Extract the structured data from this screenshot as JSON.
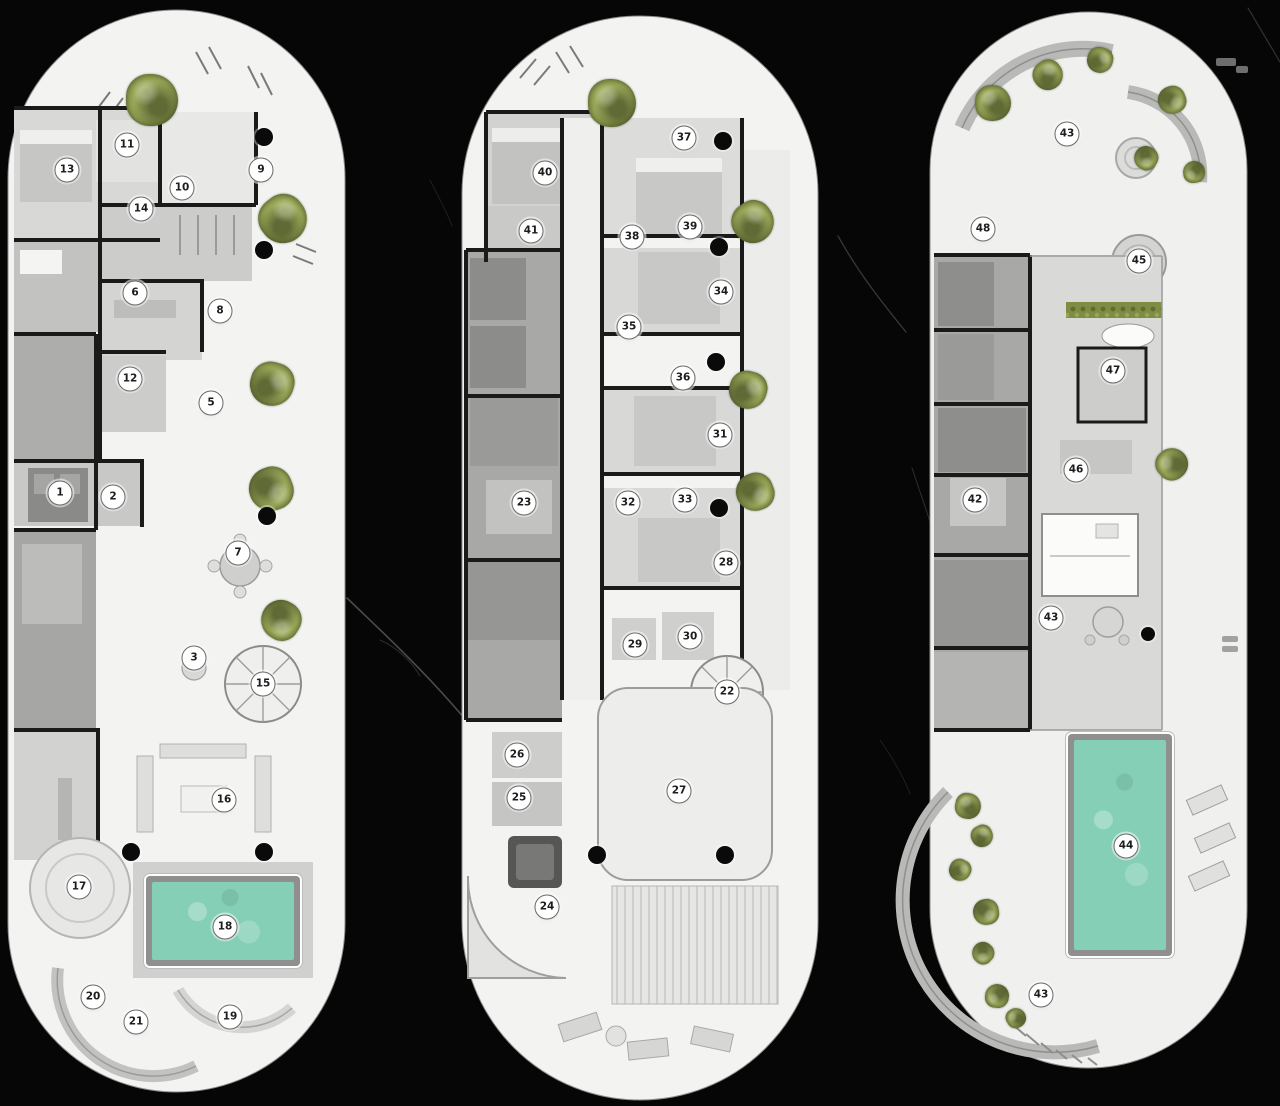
{
  "canvas": {
    "width": 1280,
    "height": 1106,
    "background": "#060606"
  },
  "colors": {
    "plan_fill": "#f3f3f1",
    "pool": "#84cfb5",
    "plant": "#89984b",
    "plant_light": "#9dab5c",
    "plant_dark": "#5f6c2f",
    "marker_bg": "#ffffff",
    "marker_border": "#6b6b6b",
    "marker_text": "#1c1c1c",
    "column": "#0a0a0a"
  },
  "plans": [
    {
      "id": "floor-plan-1",
      "markers": [
        {
          "n": "11",
          "x": 127,
          "y": 145
        },
        {
          "n": "13",
          "x": 67,
          "y": 170
        },
        {
          "n": "9",
          "x": 261,
          "y": 170
        },
        {
          "n": "10",
          "x": 182,
          "y": 188
        },
        {
          "n": "14",
          "x": 141,
          "y": 209
        },
        {
          "n": "6",
          "x": 135,
          "y": 293
        },
        {
          "n": "8",
          "x": 220,
          "y": 311
        },
        {
          "n": "12",
          "x": 130,
          "y": 379
        },
        {
          "n": "5",
          "x": 211,
          "y": 403
        },
        {
          "n": "1",
          "x": 60,
          "y": 493
        },
        {
          "n": "2",
          "x": 113,
          "y": 497
        },
        {
          "n": "7",
          "x": 238,
          "y": 553
        },
        {
          "n": "3",
          "x": 194,
          "y": 658
        },
        {
          "n": "15",
          "x": 263,
          "y": 684
        },
        {
          "n": "16",
          "x": 224,
          "y": 800
        },
        {
          "n": "17",
          "x": 79,
          "y": 887
        },
        {
          "n": "18",
          "x": 225,
          "y": 927
        },
        {
          "n": "20",
          "x": 93,
          "y": 997
        },
        {
          "n": "19",
          "x": 230,
          "y": 1017
        },
        {
          "n": "21",
          "x": 136,
          "y": 1022
        }
      ],
      "plants": [
        {
          "x": 152,
          "y": 100,
          "r": 26
        },
        {
          "x": 283,
          "y": 219,
          "r": 24
        },
        {
          "x": 272,
          "y": 384,
          "r": 22
        },
        {
          "x": 271,
          "y": 489,
          "r": 22
        },
        {
          "x": 281,
          "y": 620,
          "r": 20
        }
      ],
      "columns": [
        {
          "x": 264,
          "y": 137,
          "d": 18
        },
        {
          "x": 264,
          "y": 250,
          "d": 18
        },
        {
          "x": 267,
          "y": 516,
          "d": 18
        },
        {
          "x": 131,
          "y": 852,
          "d": 18
        },
        {
          "x": 264,
          "y": 852,
          "d": 18
        }
      ],
      "pools": [
        {
          "x": 146,
          "y": 876,
          "w": 154,
          "h": 90
        }
      ]
    },
    {
      "id": "floor-plan-2",
      "markers": [
        {
          "n": "37",
          "x": 684,
          "y": 138
        },
        {
          "n": "40",
          "x": 545,
          "y": 173
        },
        {
          "n": "39",
          "x": 690,
          "y": 227
        },
        {
          "n": "41",
          "x": 531,
          "y": 231
        },
        {
          "n": "38",
          "x": 632,
          "y": 237
        },
        {
          "n": "34",
          "x": 721,
          "y": 292
        },
        {
          "n": "35",
          "x": 629,
          "y": 327
        },
        {
          "n": "36",
          "x": 683,
          "y": 378
        },
        {
          "n": "31",
          "x": 720,
          "y": 435
        },
        {
          "n": "33",
          "x": 685,
          "y": 500
        },
        {
          "n": "23",
          "x": 524,
          "y": 503
        },
        {
          "n": "32",
          "x": 628,
          "y": 503
        },
        {
          "n": "28",
          "x": 726,
          "y": 563
        },
        {
          "n": "30",
          "x": 690,
          "y": 637
        },
        {
          "n": "29",
          "x": 635,
          "y": 645
        },
        {
          "n": "22",
          "x": 727,
          "y": 692
        },
        {
          "n": "26",
          "x": 517,
          "y": 755
        },
        {
          "n": "27",
          "x": 679,
          "y": 791
        },
        {
          "n": "25",
          "x": 519,
          "y": 798
        },
        {
          "n": "24",
          "x": 547,
          "y": 907
        }
      ],
      "plants": [
        {
          "x": 612,
          "y": 103,
          "r": 24
        },
        {
          "x": 753,
          "y": 222,
          "r": 21
        },
        {
          "x": 748,
          "y": 390,
          "r": 19
        },
        {
          "x": 755,
          "y": 492,
          "r": 19
        }
      ],
      "columns": [
        {
          "x": 723,
          "y": 141,
          "d": 18
        },
        {
          "x": 719,
          "y": 247,
          "d": 18
        },
        {
          "x": 716,
          "y": 362,
          "d": 18
        },
        {
          "x": 719,
          "y": 508,
          "d": 18
        },
        {
          "x": 597,
          "y": 855,
          "d": 18
        },
        {
          "x": 725,
          "y": 855,
          "d": 18
        }
      ],
      "pools": []
    },
    {
      "id": "floor-plan-3",
      "markers": [
        {
          "n": "43",
          "x": 1067,
          "y": 134
        },
        {
          "n": "48",
          "x": 983,
          "y": 229
        },
        {
          "n": "45",
          "x": 1139,
          "y": 261
        },
        {
          "n": "47",
          "x": 1113,
          "y": 371
        },
        {
          "n": "46",
          "x": 1076,
          "y": 470
        },
        {
          "n": "42",
          "x": 975,
          "y": 500
        },
        {
          "n": "43",
          "x": 1051,
          "y": 618
        },
        {
          "n": "44",
          "x": 1126,
          "y": 846
        },
        {
          "n": "43",
          "x": 1041,
          "y": 995
        }
      ],
      "plants": [
        {
          "x": 993,
          "y": 103,
          "r": 18
        },
        {
          "x": 1048,
          "y": 75,
          "r": 15
        },
        {
          "x": 1100,
          "y": 60,
          "r": 13
        },
        {
          "x": 1172,
          "y": 100,
          "r": 14
        },
        {
          "x": 1146,
          "y": 158,
          "r": 12
        },
        {
          "x": 1194,
          "y": 172,
          "r": 11
        },
        {
          "x": 1172,
          "y": 464,
          "r": 16
        },
        {
          "x": 968,
          "y": 806,
          "r": 13
        },
        {
          "x": 982,
          "y": 836,
          "r": 11
        },
        {
          "x": 960,
          "y": 870,
          "r": 11
        },
        {
          "x": 986,
          "y": 912,
          "r": 13
        },
        {
          "x": 983,
          "y": 953,
          "r": 11
        },
        {
          "x": 997,
          "y": 996,
          "r": 12
        },
        {
          "x": 1016,
          "y": 1018,
          "r": 10
        }
      ],
      "columns": [
        {
          "x": 1148,
          "y": 634,
          "d": 14
        }
      ],
      "pools": [
        {
          "x": 1068,
          "y": 734,
          "w": 104,
          "h": 222
        }
      ]
    }
  ]
}
